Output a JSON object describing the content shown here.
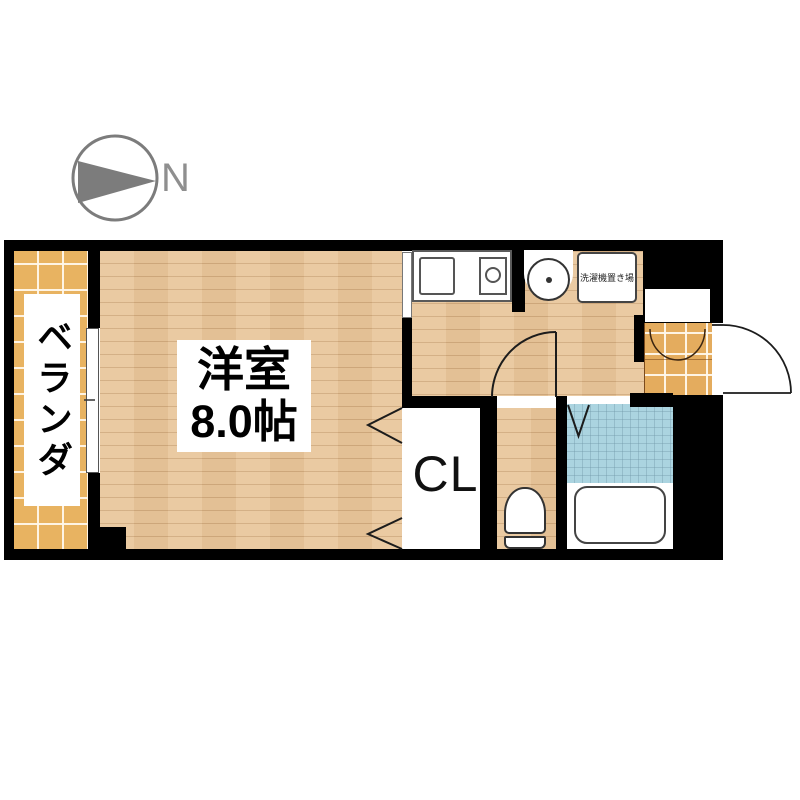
{
  "compass": {
    "label": "N",
    "icon": "compass-north-arrow-icon"
  },
  "rooms": {
    "balcony": {
      "label": "ベランダ"
    },
    "main_room": {
      "label": "洋室",
      "size": "8.0帖"
    },
    "closet": {
      "label": "CL"
    },
    "laundry_space": {
      "label": "洗濯機置き場"
    }
  },
  "fixtures": {
    "kitchen": [
      "kitchen-sink",
      "stove-burner"
    ],
    "sanitary": [
      "wash-basin",
      "toilet",
      "bathtub"
    ],
    "doors": [
      "entrance-door",
      "toilet-door",
      "bath-folding-door",
      "closet-bifold-door",
      "room-sliding-door",
      "balcony-window",
      "shoe-cabinet-doors"
    ]
  },
  "colors": {
    "wall": "#000000",
    "wood_floor": "#e9c79c",
    "balcony_tile": "#e8b361",
    "genkan_tile": "#e4ac5e",
    "bath_tile": "#abd4e0",
    "compass": "#7c7c7c",
    "label_background": "#ffffff",
    "text": "#111111"
  }
}
